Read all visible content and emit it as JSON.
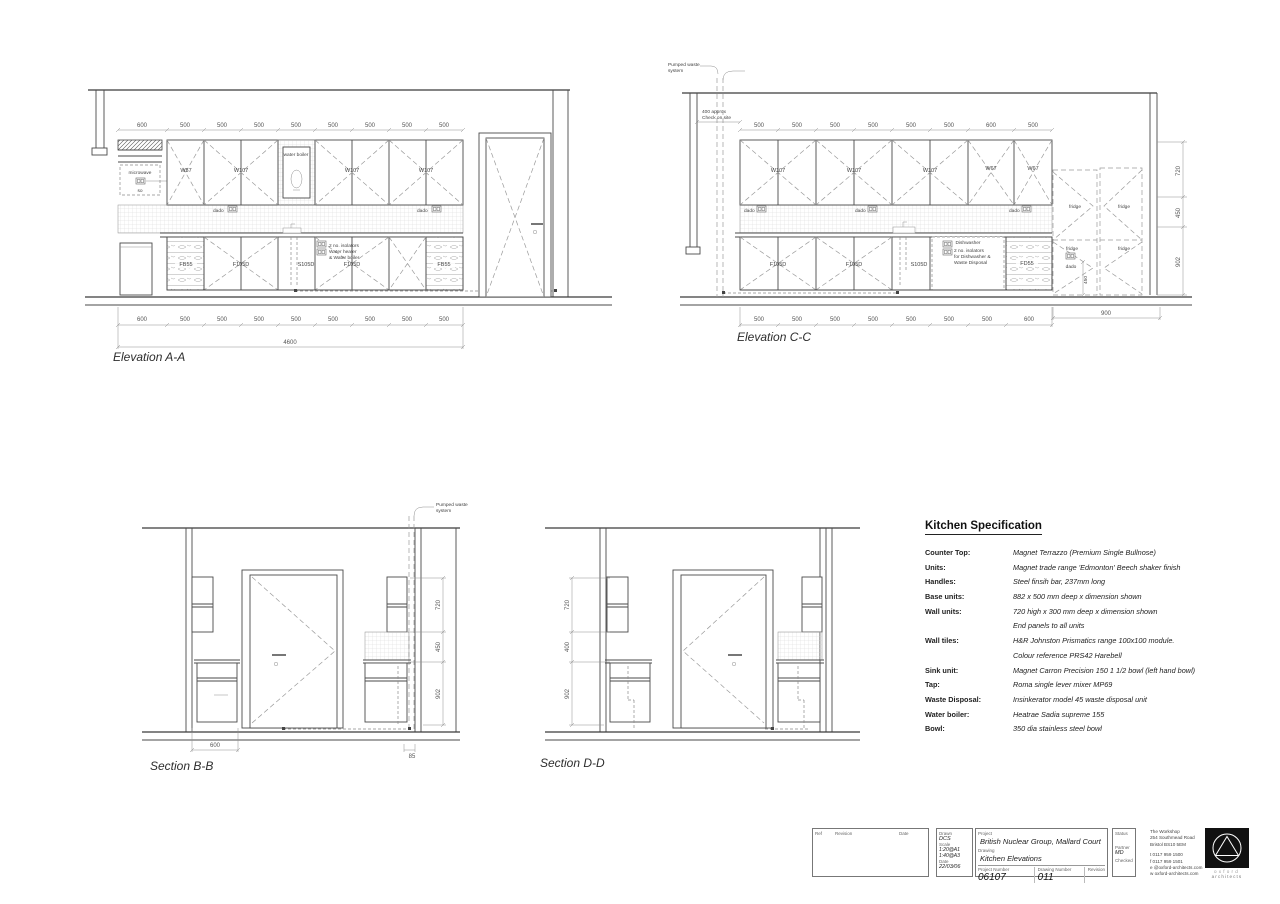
{
  "elevA": {
    "title": "Elevation A-A",
    "dims_top": [
      "600",
      "500",
      "500",
      "500",
      "500",
      "500",
      "500",
      "500",
      "500"
    ],
    "dims_bottom": [
      "600",
      "500",
      "500",
      "500",
      "500",
      "500",
      "500",
      "500",
      "500"
    ],
    "dim_total": "4600",
    "wall_labels": [
      "W57",
      "W107",
      "W107",
      "W107"
    ],
    "microwave": "microwave",
    "socket_small": "so",
    "boiler": "water boiler",
    "dado": "dado",
    "base_labels": [
      "FB55",
      "F105D",
      "S105D",
      "F105D",
      "FB55"
    ],
    "note_lines": [
      "2 no. isolators",
      "Water heater",
      "& Water boiler"
    ]
  },
  "elevC": {
    "title": "Elevation C-C",
    "pumped_lines": [
      "Pumped waste",
      "system"
    ],
    "check_lines": [
      "400 approx",
      "Check on site"
    ],
    "dims_top": [
      "500",
      "500",
      "500",
      "500",
      "500",
      "500",
      "600",
      "500"
    ],
    "dims_bottom": [
      "500",
      "500",
      "500",
      "500",
      "500",
      "500",
      "500",
      "600"
    ],
    "dims_right": [
      "720",
      "450",
      "902"
    ],
    "dim_fridge": "900",
    "dim_socket": "450",
    "wall_labels": [
      "W107",
      "W107",
      "W107",
      "W67",
      "W67"
    ],
    "base_labels": [
      "F105D",
      "F105D",
      "S105D",
      "FD55"
    ],
    "dishwasher": "Dishwasher",
    "fridge": "fridge",
    "dado": "dado",
    "note_lines": [
      "2 no. isolators",
      "for Dishwasher &",
      "Waste Disposal"
    ]
  },
  "sectionB": {
    "title": "Section B-B",
    "pumped_lines": [
      "Pumped waste",
      "system"
    ],
    "dims_right": [
      "720",
      "450",
      "902"
    ],
    "dims_bottom": [
      "600",
      "85"
    ]
  },
  "sectionD": {
    "title": "Section D-D",
    "dims_left": [
      "720",
      "400",
      "902"
    ]
  },
  "spec": {
    "title": "Kitchen Specification",
    "rows": [
      {
        "label": "Counter Top:",
        "value": "Magnet Terrazzo (Premium Single Bullnose)"
      },
      {
        "label": "Units:",
        "value": "Magnet trade range 'Edmonton' Beech shaker finish"
      },
      {
        "label": "Handles:",
        "value": "Steel finsih bar, 237mm long"
      },
      {
        "label": "Base units:",
        "value": "882 x 500 mm deep x dimension shown"
      },
      {
        "label": "Wall units:",
        "value": "720 high x 300 mm deep x dimension shown"
      },
      {
        "label": "",
        "value": "End panels to all units"
      },
      {
        "label": "Wall tiles:",
        "value": "H&R Johnston Prismatics range 100x100 module."
      },
      {
        "label": "",
        "value": "Colour reference PRS42 Harebell"
      },
      {
        "label": "Sink unit:",
        "value": "Magnet Carron Precision 150 1 1/2 bowl (left hand bowl)"
      },
      {
        "label": "Tap:",
        "value": "Roma single lever mixer MP69"
      },
      {
        "label": "Waste Disposal:",
        "value": "Insinkerator model 45 waste disposal unit"
      },
      {
        "label": "Water boiler:",
        "value": "Heatrae Sadia supreme 155"
      },
      {
        "label": "Bowl:",
        "value": "350 dia stainless steel bowl"
      }
    ]
  },
  "titleblock": {
    "ref": "Ref",
    "revision": "Revision",
    "date": "Date",
    "drawn_label": "Drawn",
    "drawn": "DCS",
    "scale_label": "Scale",
    "scale_a1": "1:20@A1",
    "scale_a3": "1:40@A3",
    "date_label": "Date",
    "date_value": "22/03/06",
    "project_label": "Project",
    "project": "British Nuclear Group, Mallard Court",
    "drawing_label": "Drawing",
    "drawing": "Kitchen Elevations",
    "project_number_label": "Project Number",
    "project_number": "06107",
    "drawing_number_label": "Drawing Number",
    "drawing_number": "011",
    "revision_label": "Revision",
    "status_label": "Status",
    "partner_label": "Partner",
    "partner": "MD",
    "checked_label": "Checked",
    "firm_name": "The Workshop",
    "firm_address1": "254 Southmead Road",
    "firm_address2": "Bristol BS10 5EM",
    "firm_tel": "t   0117 959 1500",
    "firm_fax": "f   0117 959 1501",
    "firm_email": "e   @oxford-architects.com",
    "firm_web": "w   oxford-architects.com",
    "logo_word1": "oxford",
    "logo_word2": "architects"
  }
}
